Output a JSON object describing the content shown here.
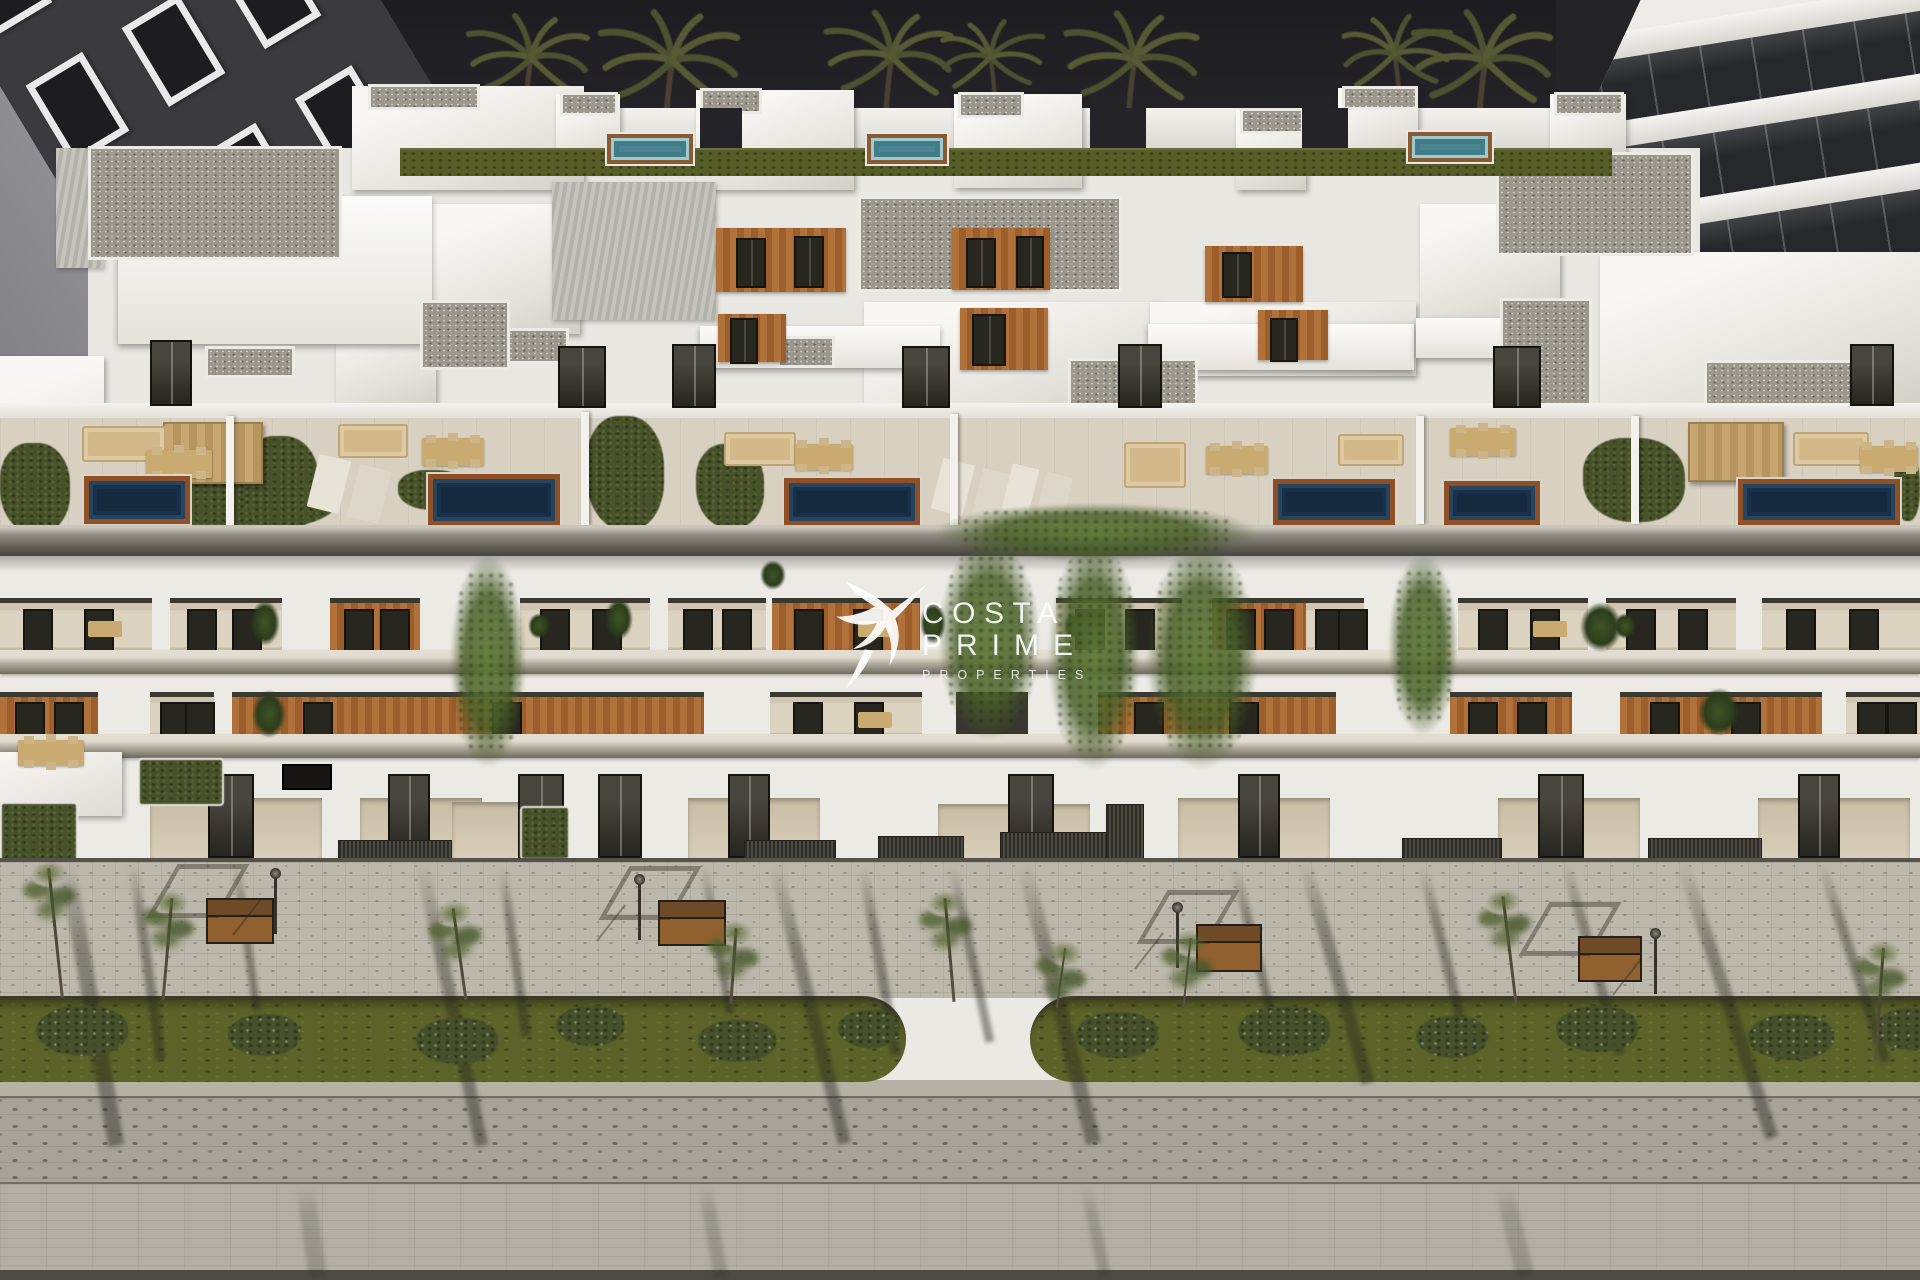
{
  "watermark": {
    "brand_top": "COSTA",
    "brand_bottom": "PRIME",
    "tagline": "PROPERTIES"
  },
  "palette": {
    "sky": "#242327",
    "white_wall": "#eceae5",
    "wood_accent": "#b0713a",
    "terrace_pool": "#152a3e",
    "rooftop_pool": "#4b8591",
    "pool_deck": "#8f5028",
    "lawn": "#565d26",
    "street_grass": "#5c6329",
    "sidewalk": "#bcb8ab",
    "cobble": "#a7a399",
    "road": "#b3afa4",
    "palm_frond": "#4c5130",
    "watermark": "#ffffff"
  },
  "neighbor_left": {
    "rows": 4,
    "cols": 3
  },
  "neighbor_right": {
    "glass_bands": 4
  },
  "scene": {
    "palms": [
      [
        250,
        4,
        1.0,
        1
      ],
      [
        310,
        14,
        0.8,
        0
      ],
      [
        525,
        0,
        1.0,
        0
      ],
      [
        665,
        -6,
        1.15,
        0
      ],
      [
        885,
        -4,
        1.05,
        0
      ],
      [
        995,
        8,
        0.85,
        1
      ],
      [
        1128,
        -4,
        1.1,
        0
      ],
      [
        1400,
        2,
        0.9,
        1
      ],
      [
        1478,
        -6,
        1.15,
        0
      ],
      [
        1725,
        -2,
        1.0,
        1
      ],
      [
        1810,
        -4,
        0.95,
        0
      ],
      [
        1895,
        6,
        0.8,
        1
      ]
    ],
    "sky_slits": [
      [
        700,
        108,
        42,
        66
      ],
      [
        1090,
        108,
        56,
        66
      ],
      [
        1302,
        108,
        46,
        66
      ]
    ],
    "lawn_strips": [
      [
        400,
        148,
        1212,
        26
      ]
    ],
    "teal_pools": [
      [
        607,
        134,
        86,
        30
      ],
      [
        867,
        134,
        80,
        30
      ],
      [
        1408,
        132,
        84,
        30
      ]
    ],
    "white_boxes": [
      [
        352,
        86,
        232,
        104
      ],
      [
        556,
        94,
        64,
        76
      ],
      [
        696,
        90,
        158,
        100
      ],
      [
        954,
        94,
        128,
        94
      ],
      [
        1236,
        110,
        70,
        80
      ],
      [
        1338,
        88,
        80,
        70
      ],
      [
        1550,
        94,
        76,
        64
      ],
      [
        0,
        356,
        104,
        174
      ],
      [
        430,
        204,
        150,
        130
      ],
      [
        1600,
        252,
        320,
        156
      ],
      [
        864,
        302,
        300,
        108
      ],
      [
        1150,
        302,
        266,
        74
      ],
      [
        1420,
        204,
        140,
        118
      ],
      [
        336,
        300,
        100,
        110
      ]
    ],
    "ribbed_roofs": [
      [
        552,
        182,
        164,
        138
      ],
      [
        56,
        148,
        48,
        120
      ]
    ],
    "awnings": [
      [
        118,
        196,
        314,
        148
      ],
      [
        700,
        326,
        240,
        42
      ],
      [
        1148,
        324,
        266,
        46
      ],
      [
        1416,
        318,
        150,
        40
      ]
    ],
    "gravel_roofs": [
      [
        88,
        146,
        254,
        114
      ],
      [
        1496,
        152,
        198,
        104
      ],
      [
        1500,
        298,
        92,
        114
      ],
      [
        858,
        196,
        264,
        96
      ],
      [
        1068,
        358,
        130,
        52
      ],
      [
        1704,
        360,
        152,
        46
      ],
      [
        205,
        346,
        90,
        32
      ],
      [
        505,
        328,
        64,
        36
      ],
      [
        777,
        336,
        58,
        32
      ],
      [
        560,
        92,
        58,
        24
      ],
      [
        700,
        88,
        62,
        26
      ],
      [
        958,
        92,
        66,
        26
      ],
      [
        1240,
        108,
        64,
        26
      ],
      [
        1342,
        86,
        76,
        24
      ],
      [
        368,
        84,
        112,
        26
      ],
      [
        1554,
        92,
        70,
        24
      ],
      [
        420,
        300,
        90,
        70
      ]
    ],
    "wood_panels": [
      [
        716,
        228,
        130,
        64
      ],
      [
        952,
        228,
        98,
        62
      ],
      [
        718,
        314,
        68,
        48
      ],
      [
        960,
        308,
        88,
        62
      ],
      [
        1205,
        246,
        98,
        56
      ],
      [
        1258,
        310,
        70,
        50
      ]
    ],
    "roof_windows": [
      [
        736,
        238,
        26,
        46
      ],
      [
        794,
        236,
        26,
        48
      ],
      [
        966,
        238,
        26,
        46
      ],
      [
        1016,
        236,
        24,
        48
      ],
      [
        972,
        314,
        30,
        48
      ],
      [
        1222,
        252,
        26,
        42
      ],
      [
        730,
        318,
        24,
        42
      ],
      [
        1270,
        318,
        24,
        40
      ]
    ],
    "roof_doors": [
      [
        150,
        340,
        38,
        62
      ],
      [
        558,
        346,
        44,
        58
      ],
      [
        672,
        344,
        40,
        60
      ],
      [
        902,
        346,
        44,
        58
      ],
      [
        1118,
        344,
        40,
        60
      ],
      [
        1493,
        346,
        44,
        58
      ],
      [
        1850,
        344,
        40,
        58
      ]
    ],
    "hedges": [
      [
        0,
        443,
        70,
        90
      ],
      [
        138,
        468,
        198,
        62
      ],
      [
        243,
        436,
        76,
        96
      ],
      [
        586,
        416,
        78,
        114
      ],
      [
        696,
        444,
        68,
        84
      ],
      [
        1583,
        438,
        102,
        84
      ],
      [
        1894,
        453,
        26,
        68
      ],
      [
        398,
        470,
        70,
        40
      ]
    ],
    "pergolas": [
      [
        163,
        422,
        96,
        58
      ],
      [
        1688,
        422,
        92,
        56
      ]
    ],
    "sofas": [
      [
        82,
        426,
        80,
        32
      ],
      [
        338,
        424,
        66,
        30
      ],
      [
        724,
        432,
        68,
        30
      ],
      [
        1124,
        442,
        58,
        42
      ],
      [
        1338,
        434,
        62,
        28
      ],
      [
        1793,
        432,
        72,
        30
      ]
    ],
    "dinings": [
      [
        146,
        450,
        66,
        28
      ],
      [
        422,
        438,
        62,
        28
      ],
      [
        795,
        444,
        58,
        26
      ],
      [
        1206,
        446,
        62,
        28
      ],
      [
        1450,
        428,
        66,
        28
      ],
      [
        1860,
        446,
        58,
        26
      ]
    ],
    "loungers": [
      [
        312,
        462,
        74,
        54
      ],
      [
        936,
        466,
        74,
        52
      ],
      [
        1006,
        470,
        62,
        50
      ]
    ],
    "npools": [
      [
        84,
        476,
        106,
        48
      ],
      [
        428,
        474,
        132,
        52
      ],
      [
        784,
        478,
        136,
        48
      ],
      [
        1273,
        479,
        122,
        46
      ],
      [
        1444,
        481,
        96,
        44
      ],
      [
        1738,
        479,
        162,
        46
      ]
    ],
    "dividers": [
      [
        226,
        416,
        8,
        110
      ],
      [
        581,
        412,
        8,
        114
      ],
      [
        950,
        414,
        8,
        112
      ],
      [
        1416,
        416,
        8,
        108
      ],
      [
        1631,
        416,
        8,
        108
      ]
    ],
    "vines": [
      [
        935,
        503,
        322,
        58
      ],
      [
        938,
        538,
        102,
        202
      ],
      [
        1048,
        538,
        92,
        232
      ],
      [
        1146,
        543,
        112,
        227
      ],
      [
        450,
        554,
        76,
        214
      ],
      [
        1388,
        554,
        70,
        182
      ]
    ],
    "balconies": [
      [
        0,
        598,
        152,
        58,
        "win d"
      ],
      [
        170,
        598,
        112,
        58,
        "win"
      ],
      [
        330,
        598,
        90,
        58,
        "wood win"
      ],
      [
        520,
        598,
        130,
        58,
        "win p"
      ],
      [
        668,
        598,
        98,
        58,
        "win"
      ],
      [
        772,
        598,
        148,
        58,
        "wood win d"
      ],
      [
        1056,
        598,
        126,
        58,
        "win p"
      ],
      [
        1212,
        598,
        94,
        58,
        "wood win"
      ],
      [
        1306,
        598,
        58,
        58,
        "win"
      ],
      [
        1458,
        598,
        130,
        58,
        "win d"
      ],
      [
        1606,
        598,
        130,
        58,
        "win p"
      ],
      [
        1762,
        598,
        158,
        58,
        "win"
      ],
      [
        0,
        692,
        98,
        48,
        "wood win"
      ],
      [
        150,
        692,
        64,
        48,
        "win"
      ],
      [
        232,
        692,
        472,
        48,
        "wood win"
      ],
      [
        770,
        692,
        152,
        48,
        "win d"
      ],
      [
        956,
        692,
        72,
        48,
        "dark"
      ],
      [
        1098,
        692,
        238,
        48,
        "wood win"
      ],
      [
        1450,
        692,
        122,
        48,
        "wood win"
      ],
      [
        1620,
        692,
        202,
        48,
        "wood win"
      ],
      [
        1846,
        692,
        74,
        48,
        "win"
      ]
    ],
    "plants": [
      [
        250,
        600,
        30,
        46
      ],
      [
        252,
        690,
        34,
        48
      ],
      [
        1580,
        602,
        42,
        50
      ],
      [
        1698,
        688,
        42,
        48
      ],
      [
        605,
        598,
        28,
        42
      ],
      [
        920,
        602,
        26,
        42
      ],
      [
        760,
        560,
        26,
        30
      ]
    ],
    "entries": [
      [
        150,
        798,
        172,
        64
      ],
      [
        360,
        798,
        122,
        64
      ],
      [
        688,
        798,
        132,
        64
      ],
      [
        938,
        804,
        152,
        58
      ],
      [
        1178,
        798,
        152,
        64
      ],
      [
        1498,
        798,
        142,
        64
      ],
      [
        1758,
        798,
        152,
        64
      ],
      [
        452,
        802,
        100,
        60
      ]
    ],
    "gdoors": [
      [
        208,
        774,
        42,
        80
      ],
      [
        388,
        774,
        38,
        80
      ],
      [
        518,
        774,
        42,
        80
      ],
      [
        728,
        774,
        38,
        80
      ],
      [
        1008,
        774,
        42,
        80
      ],
      [
        1238,
        774,
        38,
        80
      ],
      [
        1538,
        774,
        42,
        80
      ],
      [
        1798,
        774,
        38,
        80
      ],
      [
        598,
        774,
        40,
        80
      ]
    ],
    "planters": [
      [
        0,
        802,
        74,
        58
      ],
      [
        138,
        758,
        82,
        44
      ],
      [
        520,
        806,
        46,
        50
      ]
    ],
    "vents": [
      [
        878,
        836,
        84,
        22
      ],
      [
        1000,
        832,
        106,
        26
      ],
      [
        1106,
        804,
        36,
        54
      ],
      [
        338,
        840,
        112,
        20
      ],
      [
        1402,
        838,
        98,
        20
      ],
      [
        1648,
        838,
        112,
        20
      ],
      [
        744,
        840,
        90,
        18
      ]
    ],
    "shadows": [
      [
        58,
        860,
        16,
        290,
        -10
      ],
      [
        128,
        862,
        10,
        200,
        -8
      ],
      [
        415,
        862,
        13,
        290,
        -12
      ],
      [
        498,
        868,
        9,
        170,
        -8
      ],
      [
        768,
        862,
        13,
        290,
        -14
      ],
      [
        858,
        868,
        10,
        190,
        -10
      ],
      [
        1016,
        862,
        15,
        290,
        -14
      ],
      [
        1298,
        862,
        13,
        230,
        -16
      ],
      [
        1418,
        868,
        10,
        180,
        -14
      ],
      [
        1560,
        862,
        10,
        200,
        -16
      ],
      [
        1676,
        862,
        13,
        290,
        -18
      ],
      [
        1816,
        862,
        10,
        210,
        -18
      ],
      [
        232,
        862,
        8,
        150,
        -8
      ],
      [
        700,
        866,
        8,
        150,
        -10
      ],
      [
        948,
        866,
        9,
        180,
        -12
      ],
      [
        1230,
        866,
        9,
        180,
        -14
      ]
    ],
    "road_shadows": [
      [
        296,
        1186,
        18,
        92,
        -8
      ],
      [
        698,
        1186,
        14,
        92,
        -10
      ],
      [
        1494,
        1186,
        18,
        92,
        -14
      ],
      [
        1080,
        1186,
        12,
        92,
        -12
      ]
    ],
    "benches": [
      [
        206,
        898,
        64,
        42
      ],
      [
        658,
        900,
        64,
        42
      ],
      [
        1196,
        924,
        62,
        44
      ],
      [
        1578,
        936,
        60,
        42
      ]
    ],
    "lamps": [
      [
        274,
        878
      ],
      [
        638,
        884
      ],
      [
        1176,
        912
      ],
      [
        1654,
        938
      ]
    ],
    "grass_segments": [
      [
        -80,
        996,
        986,
        86,
        1
      ],
      [
        1030,
        996,
        1000,
        86,
        2
      ]
    ],
    "bushes": [
      [
        36,
        1006,
        92,
        50
      ],
      [
        228,
        1014,
        72,
        42
      ],
      [
        416,
        1018,
        82,
        46
      ],
      [
        556,
        1006,
        68,
        40
      ],
      [
        698,
        1020,
        78,
        42
      ],
      [
        838,
        1010,
        62,
        38
      ],
      [
        1076,
        1012,
        82,
        46
      ],
      [
        1238,
        1006,
        92,
        50
      ],
      [
        1416,
        1016,
        72,
        42
      ],
      [
        1556,
        1006,
        82,
        46
      ],
      [
        1748,
        1014,
        86,
        46
      ],
      [
        1876,
        1008,
        64,
        42
      ]
    ],
    "trees": [
      [
        54,
        868,
        3,
        130,
        -6
      ],
      [
        166,
        898,
        3,
        102,
        5
      ],
      [
        458,
        908,
        3,
        92,
        -8
      ],
      [
        732,
        928,
        3,
        76,
        4
      ],
      [
        948,
        898,
        3,
        104,
        -5
      ],
      [
        1186,
        938,
        2,
        70,
        6
      ],
      [
        1508,
        896,
        3,
        108,
        -7
      ],
      [
        1878,
        948,
        3,
        112,
        4
      ],
      [
        1060,
        948,
        2,
        60,
        8
      ]
    ]
  }
}
